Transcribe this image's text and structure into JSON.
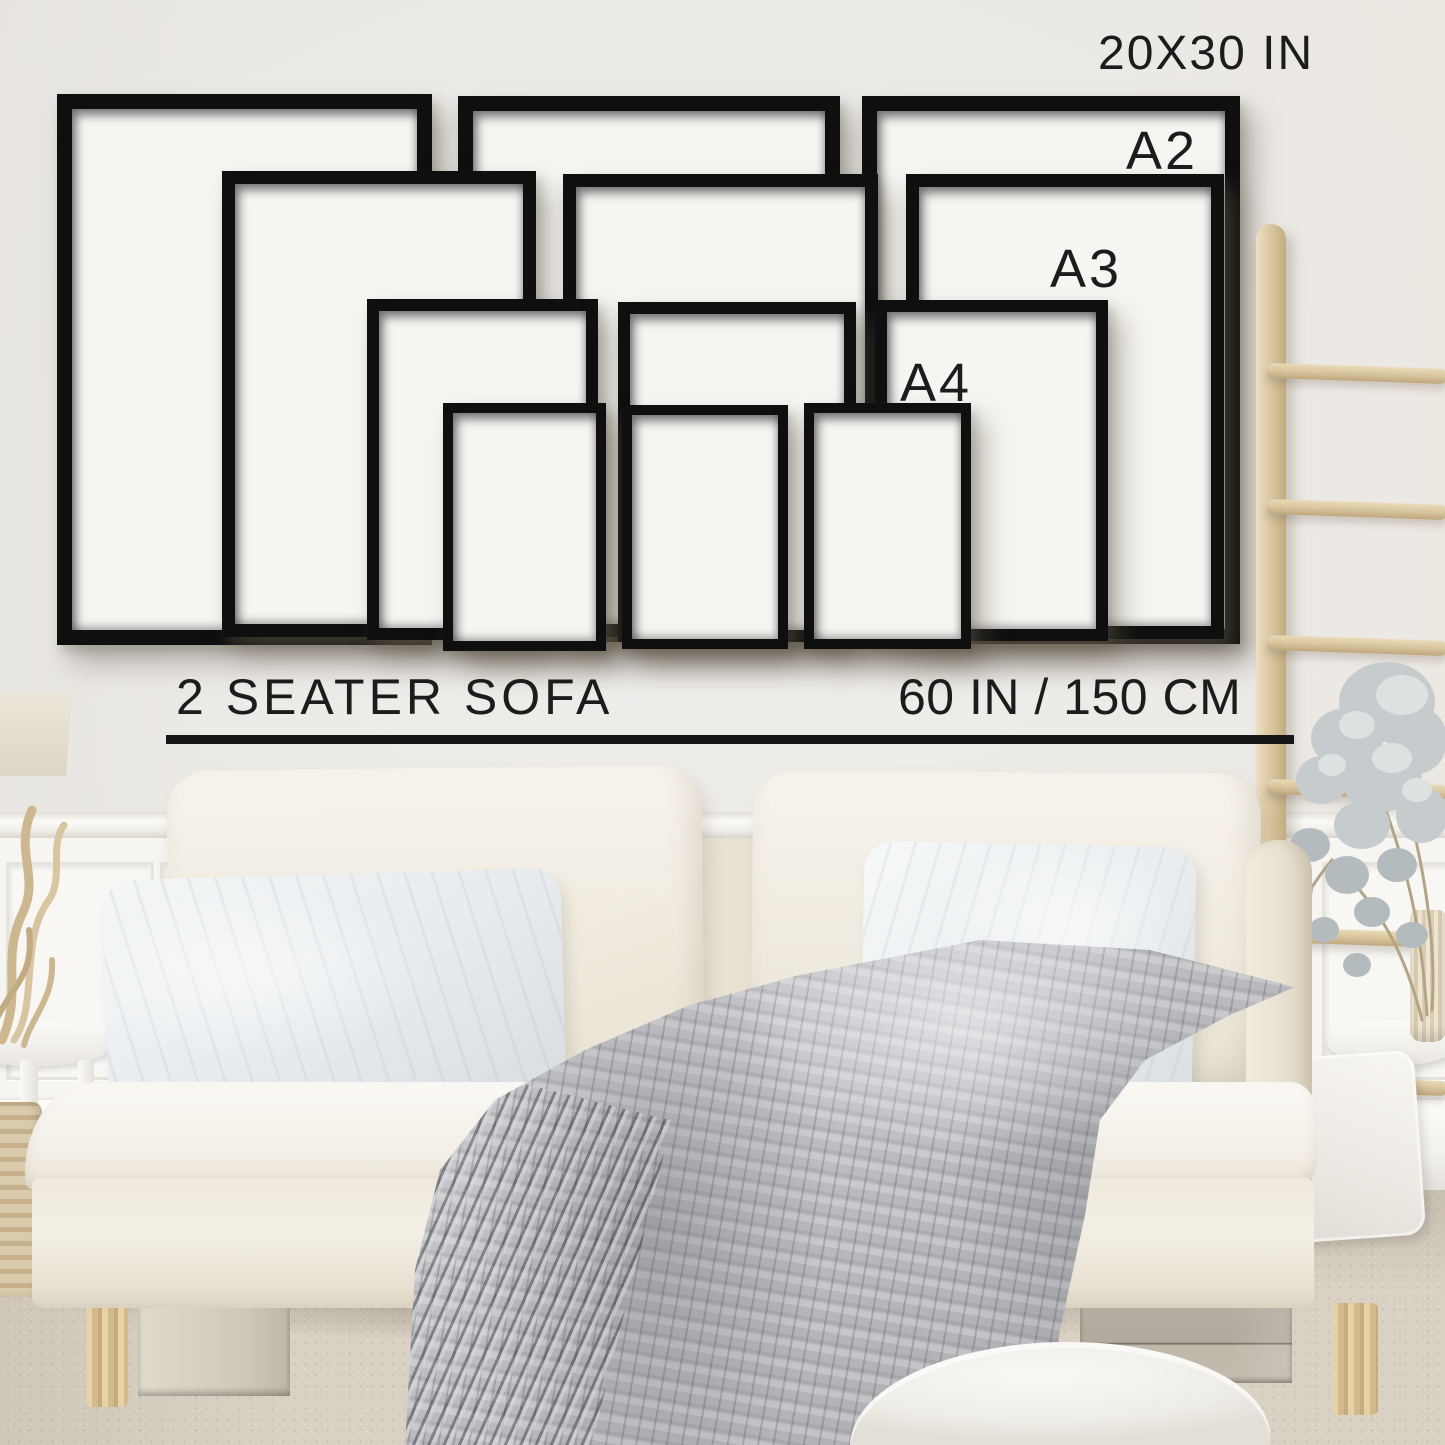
{
  "wall_labels": [
    {
      "id": "size-20x30in",
      "text": "20X30 IN",
      "x": 1098,
      "y": 30,
      "font_size": 48,
      "letter_spacing": 2
    },
    {
      "id": "size-a2",
      "text": "A2",
      "x": 1126,
      "y": 124,
      "font_size": 54,
      "letter_spacing": 3
    },
    {
      "id": "size-a3",
      "text": "A3",
      "x": 1050,
      "y": 242,
      "font_size": 54,
      "letter_spacing": 3
    },
    {
      "id": "size-a4",
      "text": "A4",
      "x": 900,
      "y": 356,
      "font_size": 54,
      "letter_spacing": 3
    }
  ],
  "frames": [
    {
      "size": "20x30in",
      "x": 57,
      "y": 94,
      "w": 375,
      "h": 551,
      "border": 15
    },
    {
      "size": "20x30in",
      "x": 458,
      "y": 96,
      "w": 382,
      "h": 546,
      "border": 15
    },
    {
      "size": "20x30in",
      "x": 862,
      "y": 96,
      "w": 378,
      "h": 548,
      "border": 15
    },
    {
      "size": "a2",
      "x": 222,
      "y": 171,
      "w": 314,
      "h": 466,
      "border": 13
    },
    {
      "size": "a2",
      "x": 563,
      "y": 174,
      "w": 315,
      "h": 463,
      "border": 13
    },
    {
      "size": "a2",
      "x": 906,
      "y": 174,
      "w": 318,
      "h": 465,
      "border": 13
    },
    {
      "size": "a3",
      "x": 367,
      "y": 299,
      "w": 231,
      "h": 341,
      "border": 12
    },
    {
      "size": "a3",
      "x": 618,
      "y": 302,
      "w": 238,
      "h": 340,
      "border": 12
    },
    {
      "size": "a3",
      "x": 875,
      "y": 300,
      "w": 233,
      "h": 341,
      "border": 12
    },
    {
      "size": "a4",
      "x": 443,
      "y": 403,
      "w": 163,
      "h": 248,
      "border": 10
    },
    {
      "size": "a4",
      "x": 622,
      "y": 405,
      "w": 166,
      "h": 244,
      "border": 10
    },
    {
      "size": "a4",
      "x": 804,
      "y": 403,
      "w": 167,
      "h": 246,
      "border": 10
    }
  ],
  "sofa_annotation": {
    "label": "2 SEATER SOFA",
    "width_label": "60 IN / 150 CM"
  },
  "ladder": {
    "rung_y": [
      366,
      502,
      638,
      782,
      930,
      1078
    ]
  },
  "colors": {
    "text": "#1c1c1c",
    "frame": "#0f0f0f",
    "frame_mat": "#f6f5f2",
    "wall": "#eae8e5",
    "wainscot": "#f6f5f2",
    "sofa_cream": "#f2eee5",
    "pillow_gray": "#e9edef",
    "blanket_gray": "#bdbec1",
    "wood_light": "#ddc9a4",
    "carpet": "#d8d0c2"
  }
}
